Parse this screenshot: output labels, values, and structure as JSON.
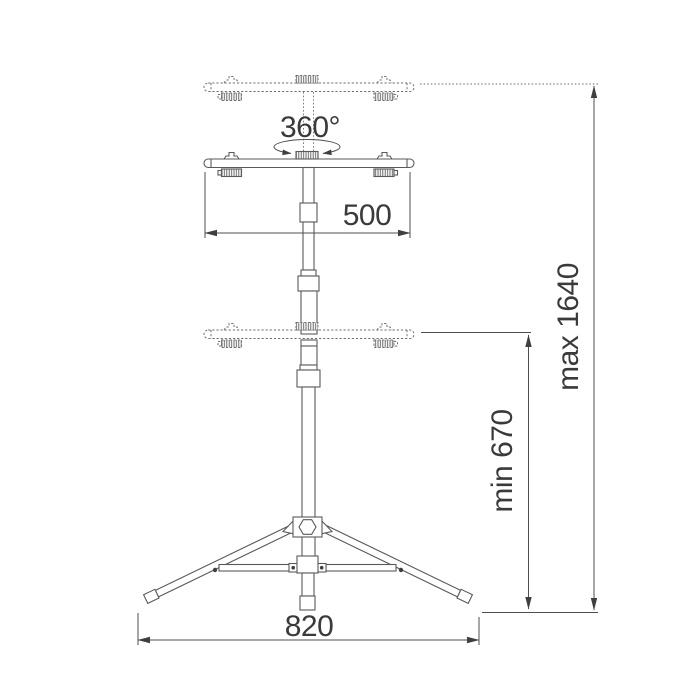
{
  "page": {
    "background": "#ffffff"
  },
  "diagram": {
    "type": "technical dimension drawing",
    "subject": "telescopic tripod stand with twin-lamp crossbar",
    "labels": {
      "rotation": "360°",
      "crossbar_width": "500",
      "min_height": "min 670",
      "max_height": "max 1640",
      "base_width": "820"
    },
    "colors": {
      "line": "#5a5a5a",
      "dimension_line": "#4f4f4f",
      "text": "#3a3a3a",
      "background": "#ffffff"
    }
  }
}
